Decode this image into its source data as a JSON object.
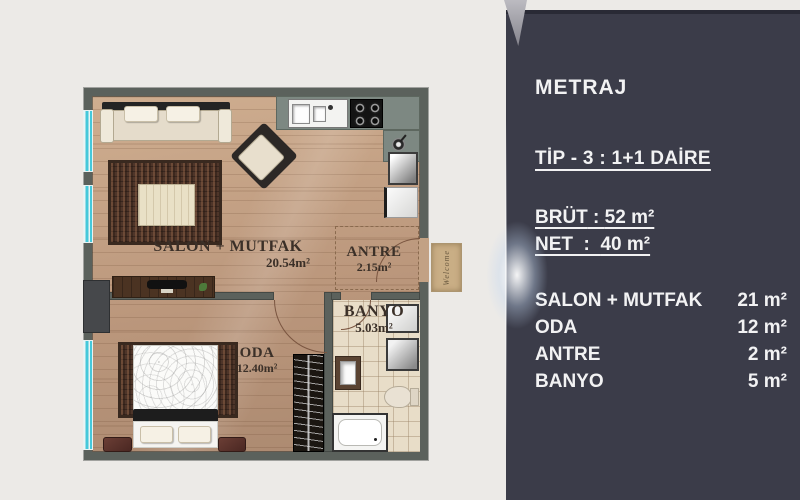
{
  "page": {
    "background_color": "#eceae7"
  },
  "plan": {
    "colors": {
      "wall": "#5b615c",
      "floor_wood": "#bb977c",
      "window_glass": "#45c8da",
      "rug": "#4e3529"
    },
    "rooms": {
      "salon": {
        "name": "SALON + MUTFAK",
        "area": "20.54m²"
      },
      "antre": {
        "name": "ANTRE",
        "area": "2.15m²"
      },
      "banyo": {
        "name": "BANYO",
        "area": "5.03m²"
      },
      "oda": {
        "name": "ODA",
        "area": "12.40m²"
      }
    },
    "door_mat_text": "Welcome"
  },
  "panel": {
    "colors": {
      "background": "#3b3c49",
      "text": "#f2f2f3"
    },
    "title": "METRAJ",
    "type_line": "TİP - 3 : 1+1 DAİRE",
    "specs": [
      {
        "label": "BRÜT",
        "sep": " : ",
        "value": "52 m²"
      },
      {
        "label": "NET",
        "sep": "  :  ",
        "value": "40 m²"
      }
    ],
    "rooms": [
      {
        "name": "SALON + MUTFAK",
        "area": "21 m²"
      },
      {
        "name": "ODA",
        "area": "12 m²"
      },
      {
        "name": "ANTRE",
        "area": "2 m²"
      },
      {
        "name": "BANYO",
        "area": "5 m²"
      }
    ]
  }
}
